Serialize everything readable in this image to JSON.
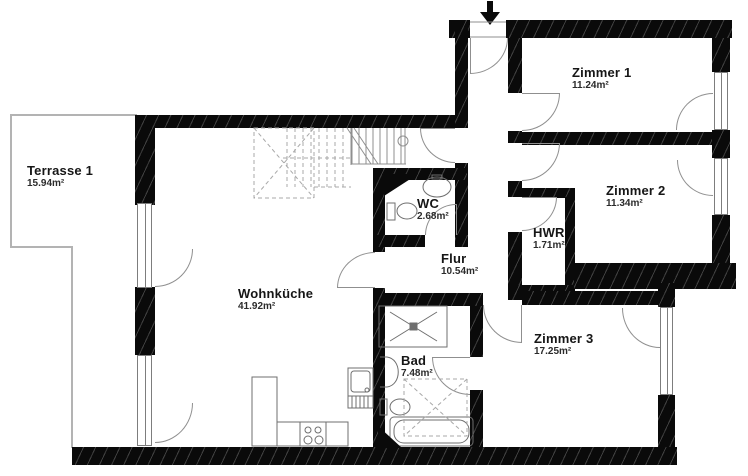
{
  "title": "floor-plan",
  "rooms": {
    "terrasse": {
      "name": "Terrasse 1",
      "area": "15.94m²"
    },
    "wohnkueche": {
      "name": "Wohnküche",
      "area": "41.92m²"
    },
    "wc": {
      "name": "WC",
      "area": "2.68m²"
    },
    "flur": {
      "name": "Flur",
      "area": "10.54m²"
    },
    "hwr": {
      "name": "HWR",
      "area": "1.71m²"
    },
    "zimmer1": {
      "name": "Zimmer 1",
      "area": "11.24m²"
    },
    "zimmer2": {
      "name": "Zimmer 2",
      "area": "11.34m²"
    },
    "zimmer3": {
      "name": "Zimmer 3",
      "area": "17.25m²"
    },
    "bad": {
      "name": "Bad",
      "area": "7.48m²"
    }
  },
  "colors": {
    "wall": "#0a0a0a",
    "line": "#8f8f8f",
    "terrace_line": "#b3b3b3",
    "text": "#161616"
  }
}
